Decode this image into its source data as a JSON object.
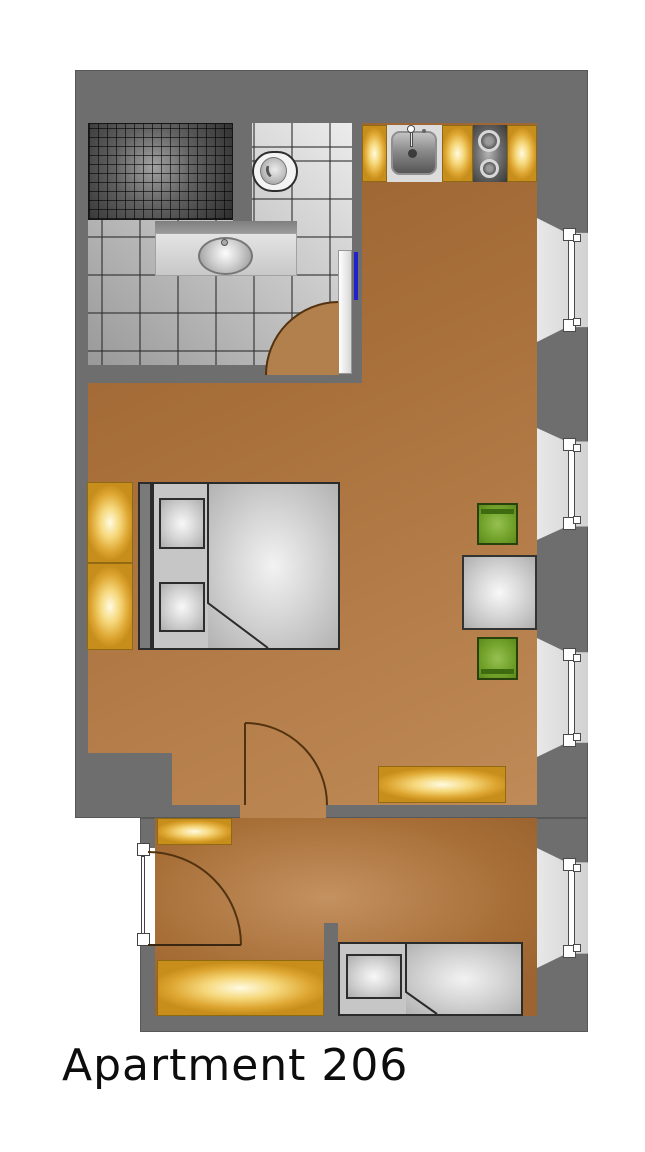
{
  "title": "Apartment 206",
  "palette": {
    "wall_gray": "#6e6e6e",
    "wood_floor_brown": "#b07c46",
    "gold_accent": "#e2ae3c",
    "chair_green": "#74a42c",
    "tile_gray": "#d9d9d9",
    "bed_gray": "#c6c6c6",
    "door_marker_blue": "#2222cc"
  },
  "fixtures": [
    "shower",
    "toilet",
    "vanity-sink",
    "bathroom-door",
    "kitchen-sink",
    "stove",
    "kitchen-cabinets",
    "double-bed",
    "pillows",
    "wardrobe",
    "table",
    "chairs",
    "radiators",
    "windows",
    "interior-door",
    "entry-door",
    "single-bed",
    "hall"
  ]
}
